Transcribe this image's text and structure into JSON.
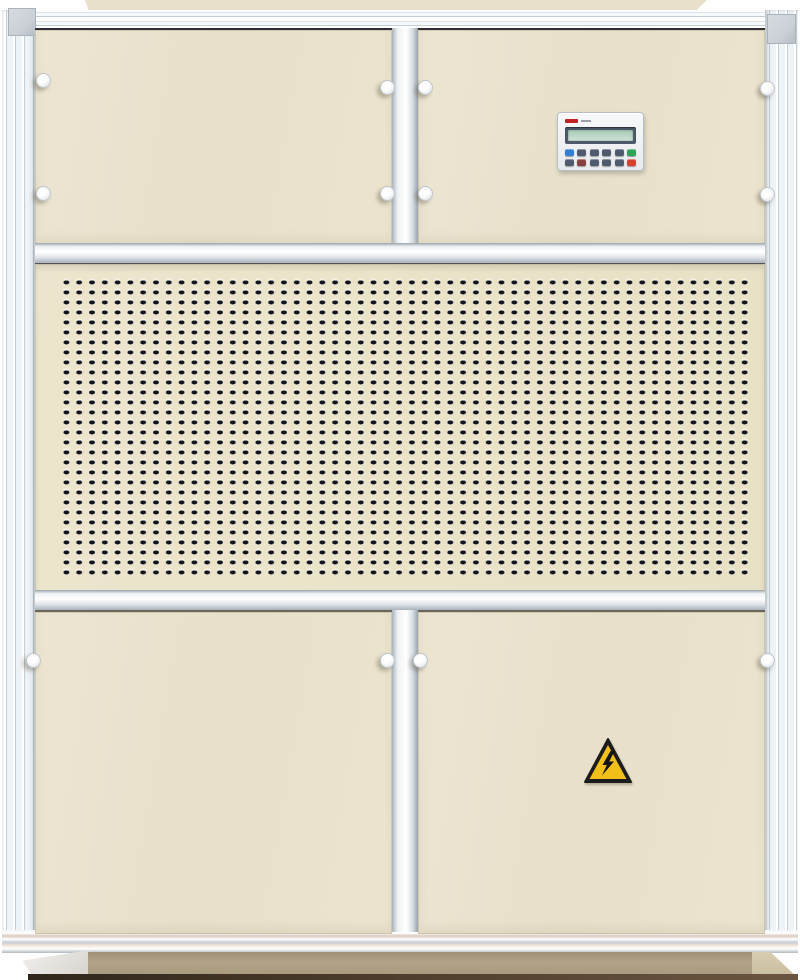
{
  "meta": {
    "image_type": "photograph",
    "subject": "Industrial air-handling / dehumidifier cabinet, front view",
    "visible_text": "none legible (small red brand mark on controller is illegible)"
  },
  "cabinet": {
    "frame": {
      "material": "extruded aluminum, silver",
      "corner_brackets": 2
    },
    "sections_top_to_bottom": [
      "roof cap strip",
      "two access door panels with controller on right door",
      "perforated louver grille panel",
      "two large access door panels (high-voltage sticker on right door)",
      "recessed plinth base on floor"
    ],
    "panel_finish": "cream / beige powder coat",
    "titles": {
      "unit": "air handling unit cabinet",
      "controller": "controller display panel",
      "grille": "perforated air intake grille",
      "warning": "high voltage warning label",
      "knob": "round latch knob"
    }
  },
  "controller": {
    "brand_mark": "small red logo (illegible)",
    "display": {
      "type": "LCD strip",
      "state": "blank",
      "screen_color": "#bcd9c8",
      "bezel_color": "#4e5a6c"
    },
    "buttons_row1": [
      "blue",
      "slate",
      "slate",
      "slate",
      "slate",
      "green"
    ],
    "buttons_row2": [
      "slate",
      "maroon",
      "slate",
      "slate",
      "slate",
      "red"
    ]
  },
  "warning_label": {
    "icon": "high-voltage-lightning-triangle",
    "shape": "triangle",
    "background": "#f2bf1b",
    "border": "#1c1c1c",
    "symbol": "lightning bolt with arrow tip"
  },
  "grille": {
    "pattern": "rectangular punched slots",
    "approx_columns": 54,
    "approx_rows": 30,
    "slot_color": "#12121a"
  },
  "latches": {
    "count": 12,
    "style": "round white knob",
    "color": "#fdfdfd"
  },
  "theme": {
    "panel-beige": "#e7e0ca",
    "grille-beige": "#eae3c8",
    "panel-edge-dark": "#2e2e35",
    "roof-beige": "#e8e1c9",
    "roof-edge": "#bcae8d",
    "rail-mid": "#dce3e9",
    "rail-dark": "#c6ced5",
    "bracket": "#ccd1d7",
    "slot-dark": "#12121a",
    "slot-sheen": "#46566c",
    "plinth": "#b2a387",
    "floor": "#c8bc9f",
    "ground-line": "#6b5540",
    "knob": "#f2f4f6",
    "lcd-bezel": "#4e5a6c",
    "lcd-screen": "#bcd9c8",
    "btn-slate": "#4f5a6e",
    "btn-blue": "#2f7fd6",
    "btn-green": "#2ea356",
    "btn-red": "#d6402e",
    "btn-maroon": "#8a4040",
    "logo-red": "#c32222",
    "warn-yellow": "#f2bf1b"
  }
}
